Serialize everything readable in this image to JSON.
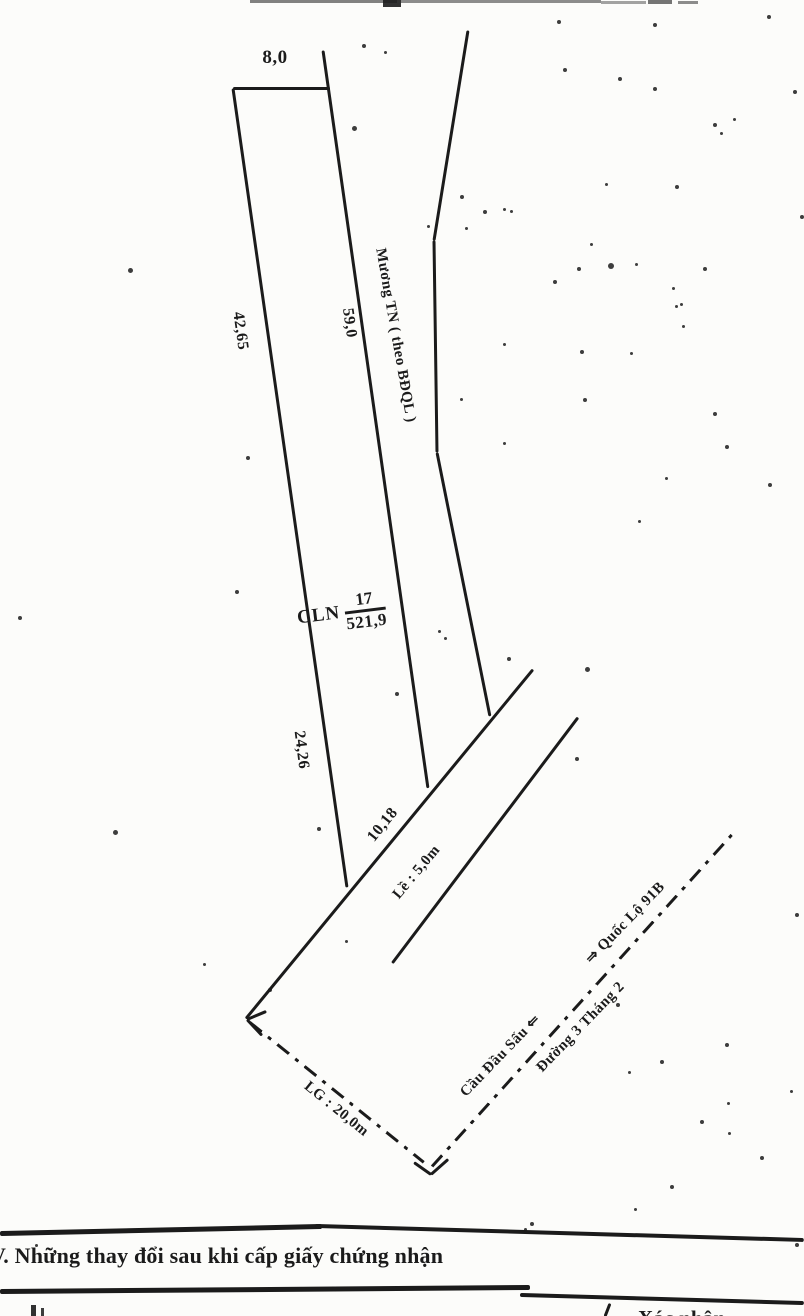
{
  "page": {
    "paper_color": "#fcfcfa",
    "ink_color": "#1b1b1b"
  },
  "diagram": {
    "labels": {
      "top_width": "8,0",
      "left_upper": "42,65",
      "left_lower": "24,26",
      "right_edge": "59,0",
      "canal": "Mương TN ( theo BĐQL )",
      "parcel_type": "CLN",
      "parcel_number": "17",
      "parcel_area": "521,9",
      "frontage": "10,18",
      "sidewalk": "Lề : 5,0m",
      "road_width": "LG : 20,0m",
      "direction_left": "Cầu Đầu Sấu ⇐",
      "direction_right": "⇒ Quốc Lộ 91B",
      "road_name": "Đường 3 Tháng 2"
    },
    "lines": [
      {
        "name": "parcel-top-edge",
        "x1": 233,
        "y1": 88,
        "x2": 330,
        "y2": 88,
        "style": "solid",
        "w": 3
      },
      {
        "name": "parcel-left-edge",
        "x1": 233,
        "y1": 88,
        "x2": 347,
        "y2": 887,
        "style": "solid",
        "w": 3
      },
      {
        "name": "parcel-right-edge",
        "x1": 323,
        "y1": 50,
        "x2": 428,
        "y2": 788,
        "style": "solid",
        "w": 3
      },
      {
        "name": "canal-segment-1",
        "x1": 468,
        "y1": 30,
        "x2": 434,
        "y2": 240,
        "style": "solid",
        "w": 3
      },
      {
        "name": "canal-segment-2",
        "x1": 434,
        "y1": 240,
        "x2": 437,
        "y2": 452,
        "style": "solid",
        "w": 3
      },
      {
        "name": "canal-segment-3",
        "x1": 437,
        "y1": 452,
        "x2": 490,
        "y2": 716,
        "style": "solid",
        "w": 3
      },
      {
        "name": "road-edge-upper",
        "x1": 533,
        "y1": 669,
        "x2": 246,
        "y2": 1018,
        "style": "solid",
        "w": 3
      },
      {
        "name": "road-edge-lower",
        "x1": 578,
        "y1": 717,
        "x2": 392,
        "y2": 963,
        "style": "solid",
        "w": 3
      },
      {
        "name": "lg-dashdot-line",
        "x1": 250,
        "y1": 1022,
        "x2": 424,
        "y2": 1162,
        "style": "dashdot",
        "w": 3
      },
      {
        "name": "road-centerline",
        "x1": 432,
        "y1": 1166,
        "x2": 733,
        "y2": 833,
        "style": "dashdot",
        "w": 3
      },
      {
        "name": "arrowhead-stroke-1",
        "x1": 247,
        "y1": 1019,
        "x2": 266,
        "y2": 1011,
        "style": "solid",
        "w": 3
      },
      {
        "name": "arrowhead-stroke-2",
        "x1": 247,
        "y1": 1019,
        "x2": 262,
        "y2": 1035,
        "style": "solid",
        "w": 3
      },
      {
        "name": "tick-stroke-1",
        "x1": 414,
        "y1": 1162,
        "x2": 431,
        "y2": 1174,
        "style": "solid",
        "w": 3
      },
      {
        "name": "tick-stroke-2",
        "x1": 431,
        "y1": 1174,
        "x2": 448,
        "y2": 1159,
        "style": "solid",
        "w": 3
      },
      {
        "name": "table-rule-top-left",
        "x1": 0,
        "y1": 1233,
        "x2": 322,
        "y2": 1226,
        "style": "solid",
        "w": 5
      },
      {
        "name": "table-rule-top-right",
        "x1": 315,
        "y1": 1226,
        "x2": 804,
        "y2": 1240,
        "style": "solid",
        "w": 4
      },
      {
        "name": "table-rule-mid-left",
        "x1": 0,
        "y1": 1291,
        "x2": 530,
        "y2": 1287,
        "style": "solid",
        "w": 5
      },
      {
        "name": "table-rule-mid-right",
        "x1": 520,
        "y1": 1295,
        "x2": 804,
        "y2": 1303,
        "style": "solid",
        "w": 4
      },
      {
        "name": "column-divider",
        "x1": 610,
        "y1": 1303,
        "x2": 605,
        "y2": 1316,
        "style": "solid",
        "w": 3
      }
    ],
    "noise_dots": [
      [
        362,
        44,
        4
      ],
      [
        384,
        51,
        3
      ],
      [
        557,
        20,
        4
      ],
      [
        653,
        23,
        4
      ],
      [
        767,
        15,
        4
      ],
      [
        563,
        68,
        4
      ],
      [
        618,
        77,
        4
      ],
      [
        653,
        87,
        4
      ],
      [
        793,
        90,
        4
      ],
      [
        713,
        123,
        4
      ],
      [
        733,
        118,
        3
      ],
      [
        720,
        132,
        3
      ],
      [
        352,
        126,
        5
      ],
      [
        483,
        210,
        4
      ],
      [
        503,
        208,
        3
      ],
      [
        510,
        210,
        3
      ],
      [
        460,
        195,
        4
      ],
      [
        465,
        227,
        3
      ],
      [
        427,
        225,
        3
      ],
      [
        605,
        183,
        3
      ],
      [
        675,
        185,
        4
      ],
      [
        800,
        215,
        4
      ],
      [
        590,
        243,
        3
      ],
      [
        577,
        267,
        4
      ],
      [
        608,
        263,
        6
      ],
      [
        635,
        263,
        3
      ],
      [
        553,
        280,
        4
      ],
      [
        703,
        267,
        4
      ],
      [
        672,
        287,
        3
      ],
      [
        675,
        305,
        3
      ],
      [
        680,
        303,
        3
      ],
      [
        682,
        325,
        3
      ],
      [
        503,
        343,
        3
      ],
      [
        580,
        350,
        4
      ],
      [
        630,
        352,
        3
      ],
      [
        460,
        398,
        3
      ],
      [
        583,
        398,
        4
      ],
      [
        713,
        412,
        4
      ],
      [
        503,
        442,
        3
      ],
      [
        725,
        445,
        4
      ],
      [
        665,
        477,
        3
      ],
      [
        768,
        483,
        4
      ],
      [
        638,
        520,
        3
      ],
      [
        128,
        268,
        5
      ],
      [
        246,
        456,
        4
      ],
      [
        18,
        616,
        4
      ],
      [
        235,
        590,
        4
      ],
      [
        113,
        830,
        5
      ],
      [
        438,
        630,
        3
      ],
      [
        444,
        637,
        3
      ],
      [
        395,
        692,
        4
      ],
      [
        317,
        827,
        4
      ],
      [
        507,
        657,
        4
      ],
      [
        585,
        667,
        5
      ],
      [
        575,
        757,
        4
      ],
      [
        268,
        988,
        4
      ],
      [
        203,
        963,
        3
      ],
      [
        345,
        940,
        3
      ],
      [
        616,
        1003,
        4
      ],
      [
        660,
        1060,
        4
      ],
      [
        628,
        1071,
        3
      ],
      [
        725,
        1043,
        4
      ],
      [
        795,
        913,
        4
      ],
      [
        790,
        1090,
        3
      ],
      [
        700,
        1120,
        4
      ],
      [
        727,
        1102,
        3
      ],
      [
        728,
        1132,
        3
      ],
      [
        670,
        1185,
        4
      ],
      [
        634,
        1208,
        3
      ],
      [
        524,
        1228,
        3
      ],
      [
        760,
        1156,
        4
      ],
      [
        795,
        1243,
        4
      ],
      [
        35,
        1244,
        3
      ],
      [
        530,
        1222,
        4
      ]
    ],
    "smudge_marks": [
      [
        250,
        0,
        147,
        3,
        0.55
      ],
      [
        383,
        0,
        18,
        7,
        0.9
      ],
      [
        401,
        0,
        200,
        3,
        0.5
      ],
      [
        601,
        1,
        45,
        3,
        0.4
      ],
      [
        648,
        0,
        24,
        4,
        0.6
      ],
      [
        678,
        1,
        20,
        3,
        0.5
      ],
      [
        31,
        1305,
        5,
        11,
        0.9
      ],
      [
        41,
        1308,
        3,
        8,
        0.85
      ]
    ]
  },
  "section_v": {
    "heading": "V. Những thay đổi sau khi cấp giấy chứng nhận",
    "right_column_partial": "Xác nhận"
  }
}
